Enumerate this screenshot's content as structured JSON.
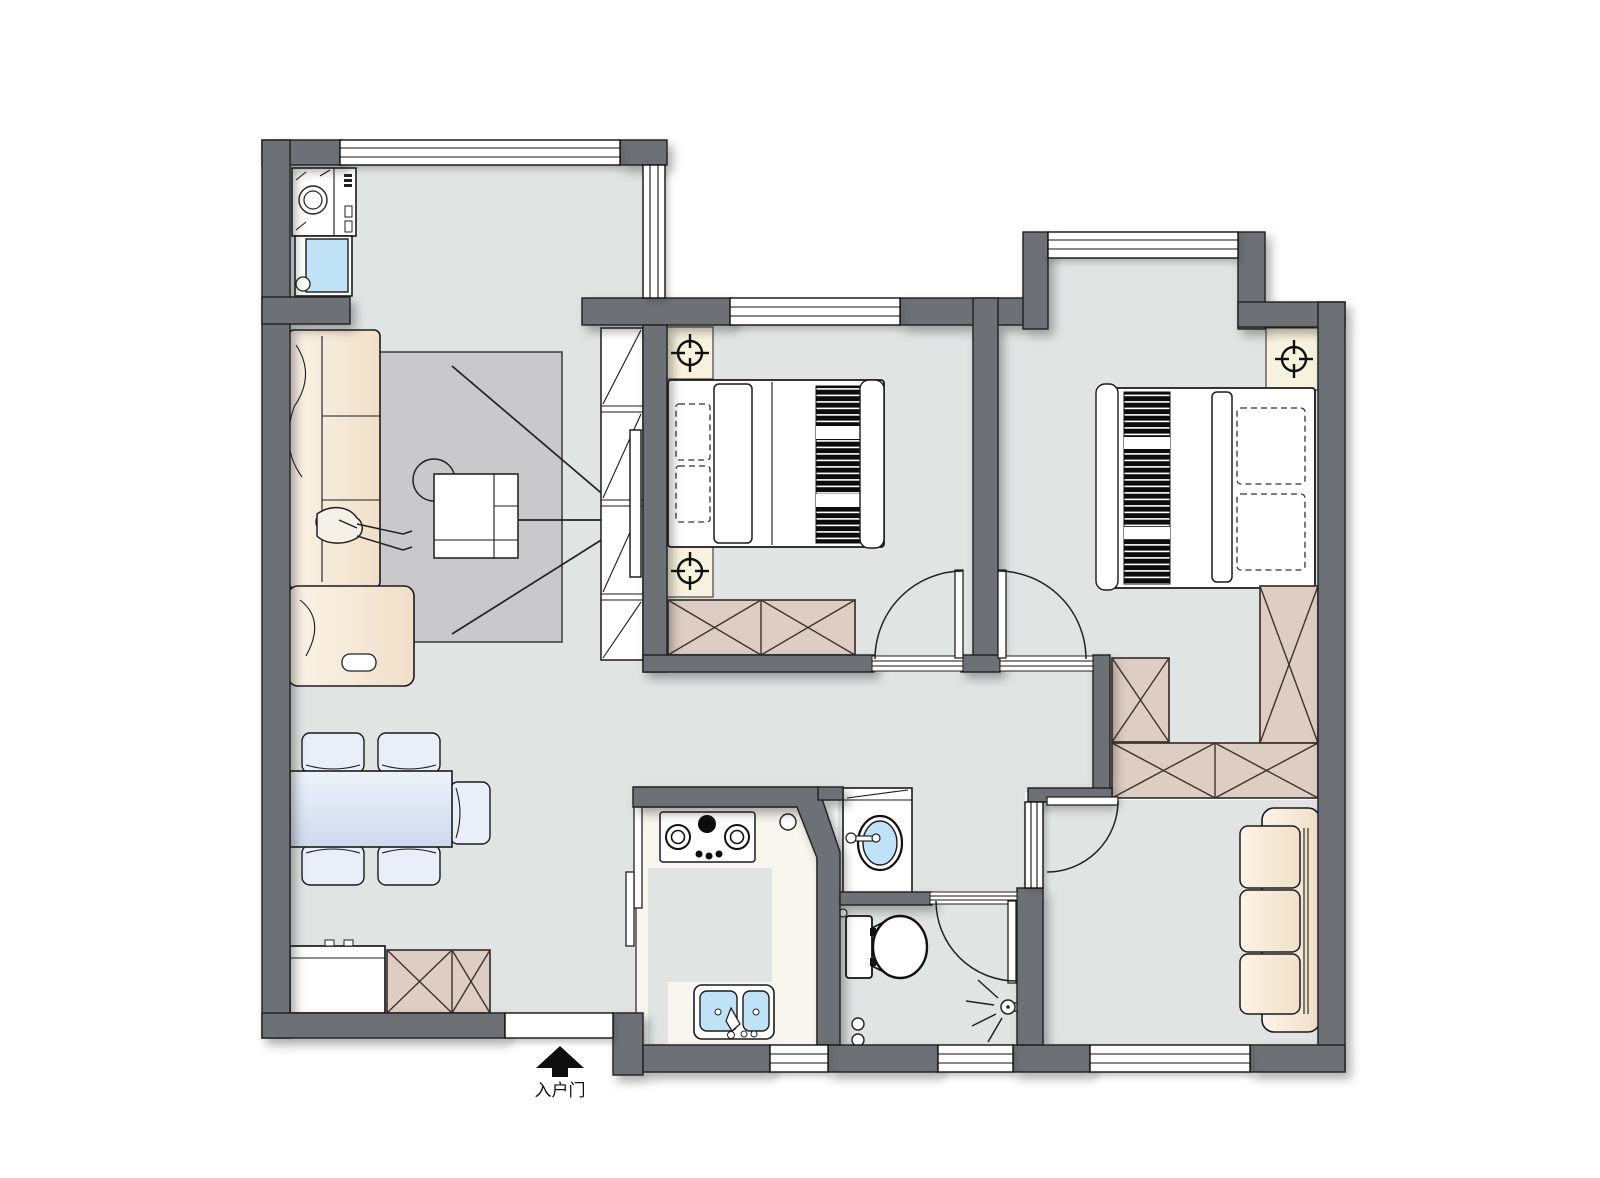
{
  "canvas": {
    "width": 1600,
    "height": 1178,
    "background": "#ffffff"
  },
  "entrance": {
    "label": "入户门",
    "icon": "entrance-arrow-icon"
  },
  "palette": {
    "wall": "#6d7175",
    "wallOutline": "#1f1f1f",
    "floor": "#e0e5e4",
    "kitchenFloor": "#f8f6ef",
    "rug": "#c9c9cb",
    "cabinetTan": "#ddcdc4",
    "cream": "#f8efe0",
    "lampPad": "#f8f3de",
    "waterBlue": "#bfe2f7",
    "tableBlue": "#dce4f2",
    "tableBlueLight": "#e9eef8",
    "white": "#ffffff",
    "line": "#1a1a1a"
  },
  "symbols": [
    "washing-machine",
    "laundry-sink",
    "sofa",
    "reading-person",
    "area-rug",
    "ottoman",
    "coffee-table",
    "tv-wall-cabinet",
    "tv-panel",
    "sight-lines",
    "dining-table",
    "dining-chair",
    "console-cabinet",
    "shoe-cabinet",
    "double-bed",
    "pillow",
    "striped-blanket",
    "nightstand",
    "ceiling-lamp",
    "wardrobe",
    "window",
    "door-swing",
    "sliding-door",
    "gas-stove",
    "kitchen-sink",
    "washbasin",
    "mirror",
    "toilet",
    "floor-drain",
    "wall-lamp",
    "entrance-arrow",
    "entrance-opening"
  ]
}
